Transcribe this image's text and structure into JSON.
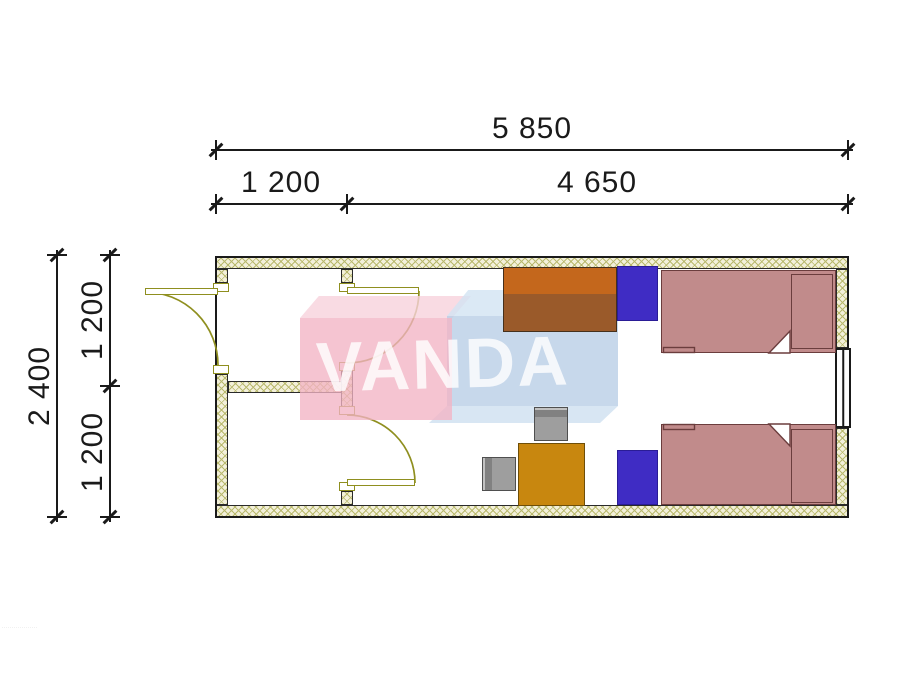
{
  "dimensions": {
    "top_total": "5 850",
    "top_segment_left": "1 200",
    "top_segment_right": "4 650",
    "side_total": "2 400",
    "side_segment_upper": "1 200",
    "side_segment_lower": "1 200"
  },
  "watermark": {
    "text": "VANDA"
  },
  "fine_print": "··················",
  "plan": {
    "type": "floor-plan",
    "openings": [
      "entrance-door",
      "interior-door-upper",
      "interior-door-lower",
      "window"
    ],
    "furniture": [
      "desk",
      "nightstand",
      "single-bed",
      "single-bed",
      "nightstand",
      "table",
      "chair",
      "chair"
    ]
  },
  "colors": {
    "dim": "#1a1a1a",
    "wall-fill": "#f3f0da",
    "wall-hatch": "#b9b96e",
    "door": "#8f8f1f",
    "bed-fill": "#c18b8b",
    "bed-line": "#6b3d3d",
    "desk-top": "#c4671c",
    "desk-body": "#9a5a2a",
    "nightstand": "#3f2cc4",
    "table": "#c8870f",
    "chair": "#9e9e9e",
    "wm-pink": "#f2b4c4",
    "wm-blue": "#b7cde6",
    "wm-letters": "#ffffff"
  }
}
